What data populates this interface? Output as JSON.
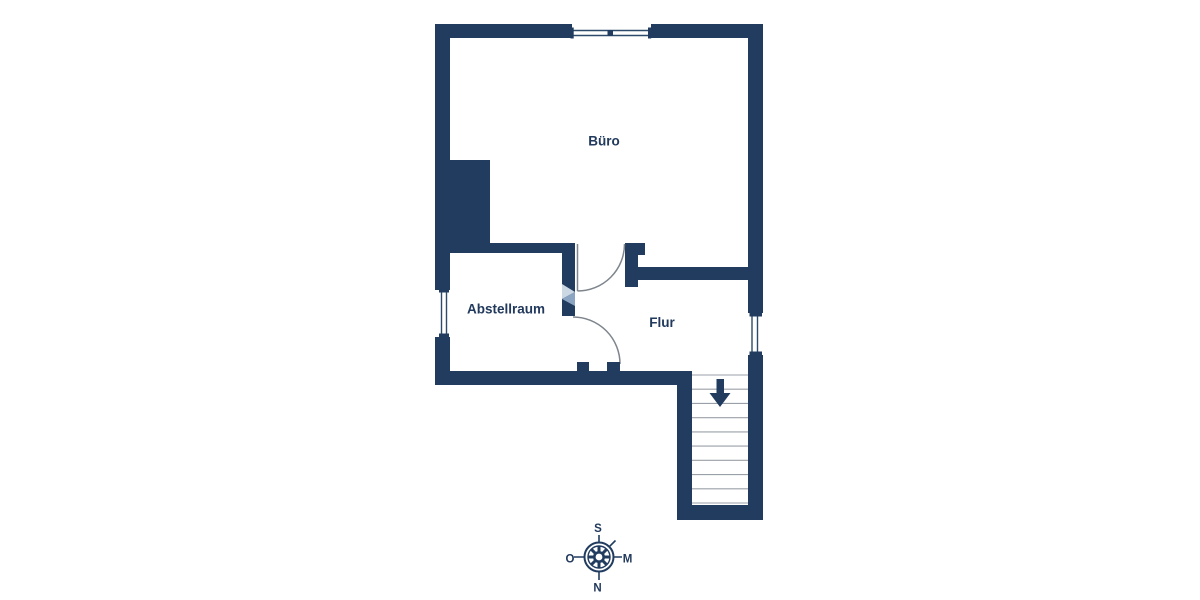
{
  "rooms": [
    {
      "id": "buero",
      "label": "Büro"
    },
    {
      "id": "abstellraum",
      "label": "Abstellraum"
    },
    {
      "id": "flur",
      "label": "Flur"
    }
  ],
  "stairs": {
    "direction": "down",
    "tread_lines": 10
  },
  "compass": {
    "top": "S",
    "right": "M",
    "bottom": "N",
    "left": "O"
  },
  "colors": {
    "wall": "#213c5f",
    "door_swing": "#7e858d",
    "stair_tread": "#9aa0a8",
    "window_line": "#2e4a6a",
    "label_text": "#21395c",
    "background": "#ffffff",
    "watermark_light": "#ccd8e4",
    "watermark_medium": "#8aa4c1"
  }
}
